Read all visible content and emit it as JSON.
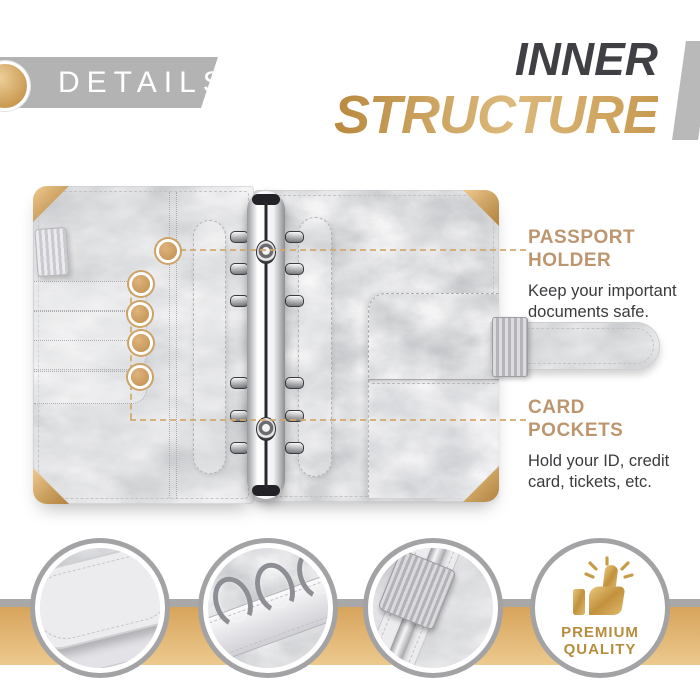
{
  "details_badge": {
    "label": "DETAILS"
  },
  "title": {
    "line1": "INNER",
    "line2": "STRUCTURE"
  },
  "callouts": {
    "passport": {
      "title": "PASSPORT\nHOLDER",
      "body": "Keep your important\ndocuments safe."
    },
    "card": {
      "title": "CARD\nPOCKETS",
      "body": "Hold your ID, credit\ncard, tickets, etc."
    }
  },
  "premium_badge": {
    "label": "PREMIUM\nQUALITY"
  },
  "thumbnails": [
    {
      "name": "pocket-closeup"
    },
    {
      "name": "binder-rings-closeup"
    },
    {
      "name": "pen-holder-closeup"
    },
    {
      "name": "premium-quality-badge"
    }
  ],
  "colors": {
    "gold_accent": "#c9995d",
    "gold_band_top": "#d7a45c",
    "gold_band_bottom": "#ecc98e",
    "banner_gray": "#b3b3b3",
    "title_dark": "#404044",
    "callout_title": "#bd9670",
    "body_text": "#3b3b3e",
    "marker_gold": "#c08f4f"
  },
  "icons": {
    "thumbs_up": "thumbs-up-icon",
    "sparkles": "sparkle-lines-icon"
  }
}
